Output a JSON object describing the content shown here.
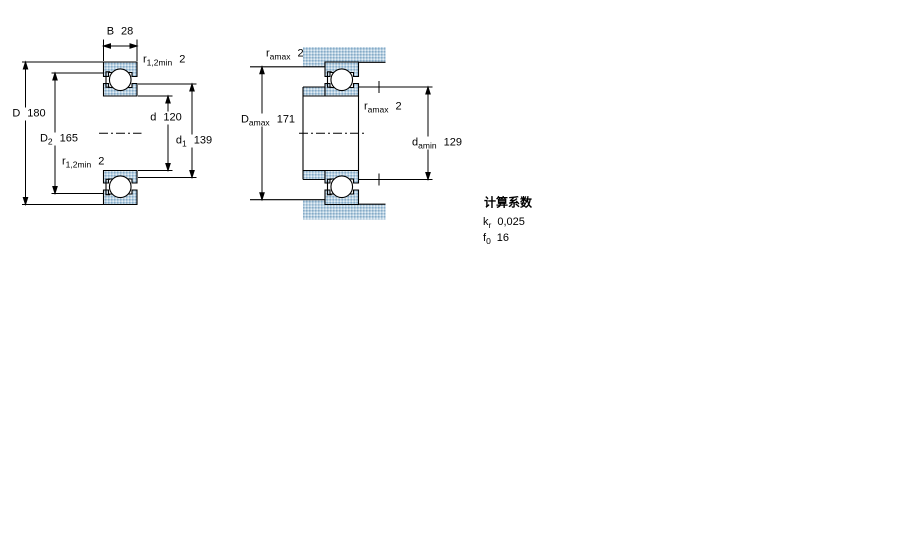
{
  "colors": {
    "hatch_base": "#b7cfe0",
    "hatch_dot_dark": "#86abc8",
    "hatch_dot_light": "#e3edf5",
    "line": "#000000",
    "background": "#ffffff"
  },
  "left_view": {
    "dim_b": {
      "sym": "B",
      "sub": "",
      "value": "28"
    },
    "dim_r_top": {
      "sym": "r",
      "sub": "1,2min",
      "value": "2"
    },
    "dim_D": {
      "sym": "D",
      "sub": "",
      "value": "180"
    },
    "dim_D2": {
      "sym": "D",
      "sub": "2",
      "value": "165"
    },
    "dim_d": {
      "sym": "d",
      "sub": "",
      "value": "120"
    },
    "dim_d1": {
      "sym": "d",
      "sub": "1",
      "value": "139"
    },
    "dim_r_bot": {
      "sym": "r",
      "sub": "1,2min",
      "value": "2"
    }
  },
  "right_view": {
    "dim_r_top": {
      "sym": "r",
      "sub": "amax",
      "value": "2"
    },
    "dim_Damax": {
      "sym": "D",
      "sub": "amax",
      "value": "171"
    },
    "dim_r_mid": {
      "sym": "r",
      "sub": "amax",
      "value": "2"
    },
    "dim_damin": {
      "sym": "d",
      "sub": "amin",
      "value": "129"
    }
  },
  "factors": {
    "title": "计算系数",
    "rows": [
      {
        "sym": "k",
        "sub": "r",
        "value": "0,025"
      },
      {
        "sym": "f",
        "sub": "0",
        "value": "16"
      }
    ]
  }
}
